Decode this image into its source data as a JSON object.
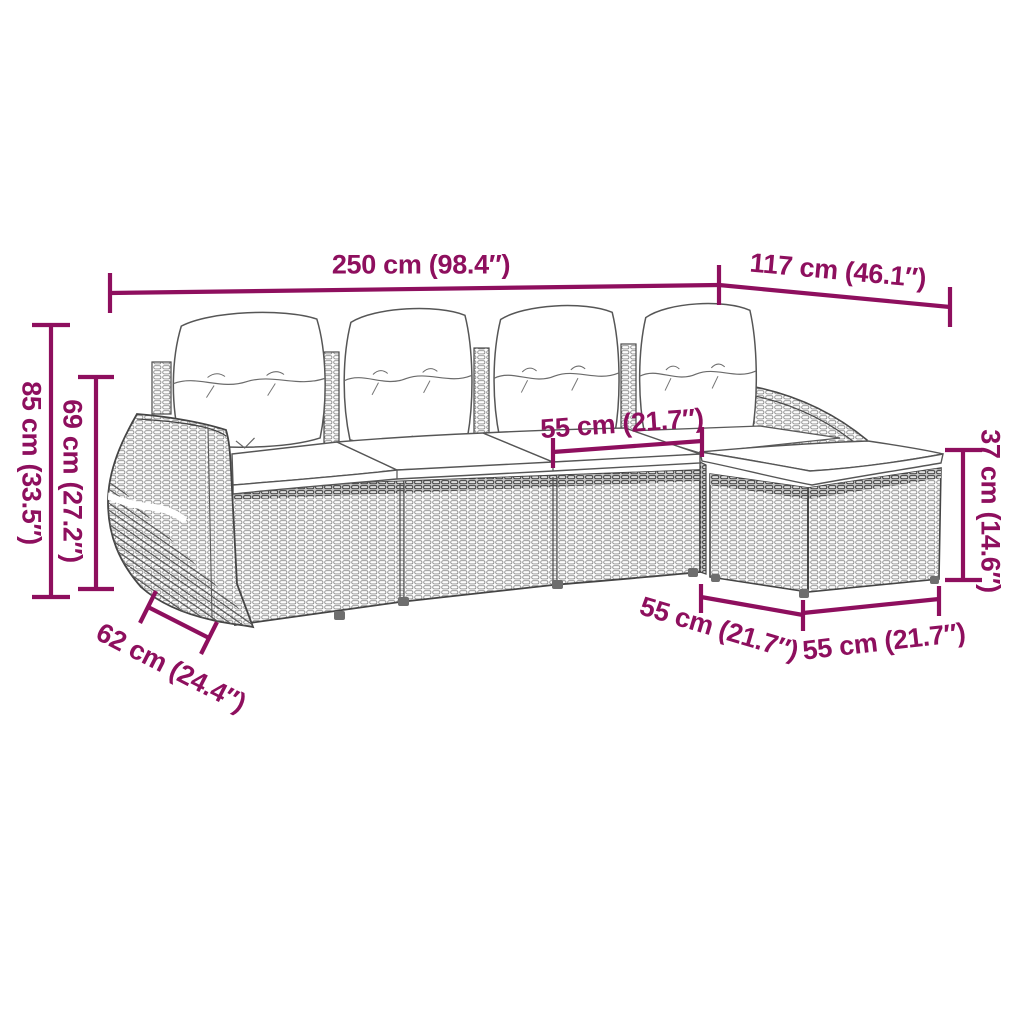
{
  "accent_color": "#8E0F5E",
  "figure": {
    "description": "Line drawing of a modular poly-rattan garden sofa set: four-seat sofa with back and seat cushions, rounded left armrest, right armrest and a footstool with cushion forming an L-shape",
    "style": "technical product dimension diagram"
  },
  "dims": {
    "total_width": "250 cm (98.4″)",
    "chaise_depth": "117 cm (46.1″)",
    "total_height": "85 cm (33.5″)",
    "back_height": "69 cm (27.2″)",
    "seat_width": "55 cm (21.7″)",
    "stool_height": "37 cm (14.6″)",
    "arm_depth": "62 cm (24.4″)",
    "stool_depth": "55 cm (21.7″)",
    "stool_width": "55 cm (21.7″)"
  }
}
